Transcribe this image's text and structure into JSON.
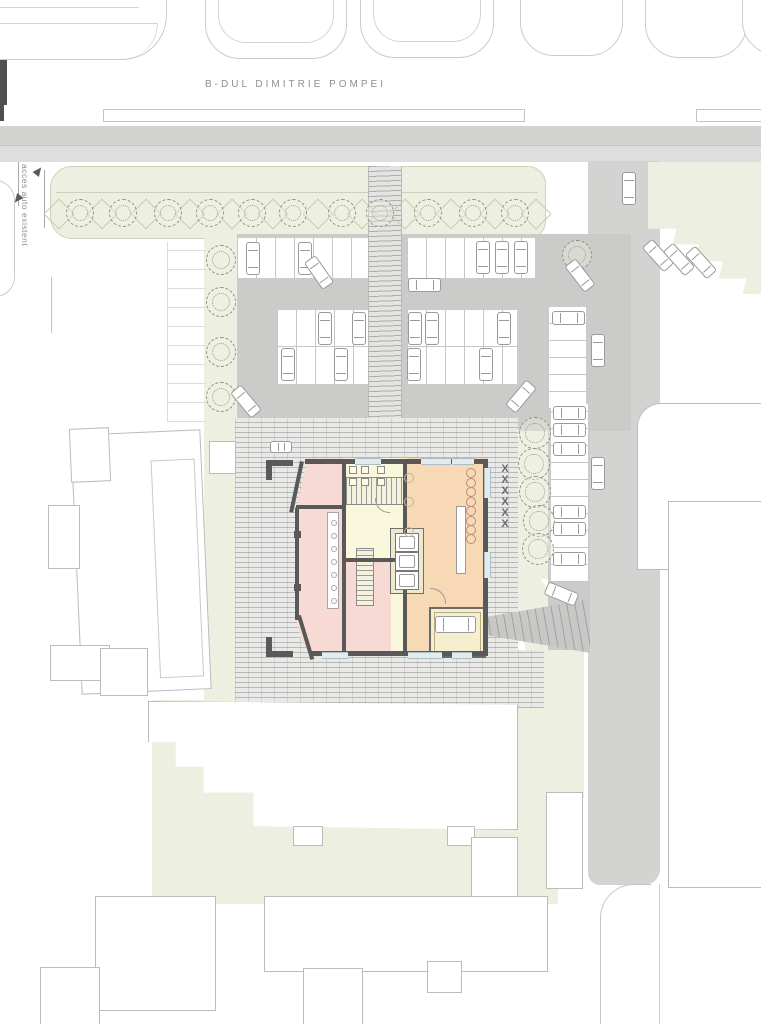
{
  "drawing": {
    "kind": "architectural site plan",
    "street_label": "B-DUL DIMITRIE POMPEI",
    "access_note": "acces auto existent",
    "masked_label": "XXXXXX"
  },
  "colors": {
    "site_green": "#edefe0",
    "road_gray": "#d3d3d2",
    "parking_asphalt": "#cbcbca",
    "plaza_paving": "#e9e9e7",
    "room_pink": "#f7dad3",
    "room_yellow": "#faf8dc",
    "room_orange": "#f7d9b6",
    "wall_dark": "#595959"
  },
  "features": {
    "street_trees": 11,
    "left_strip_trees": 4,
    "right_strip_trees": 5,
    "road_trees": 1,
    "parked_cars": 35
  }
}
